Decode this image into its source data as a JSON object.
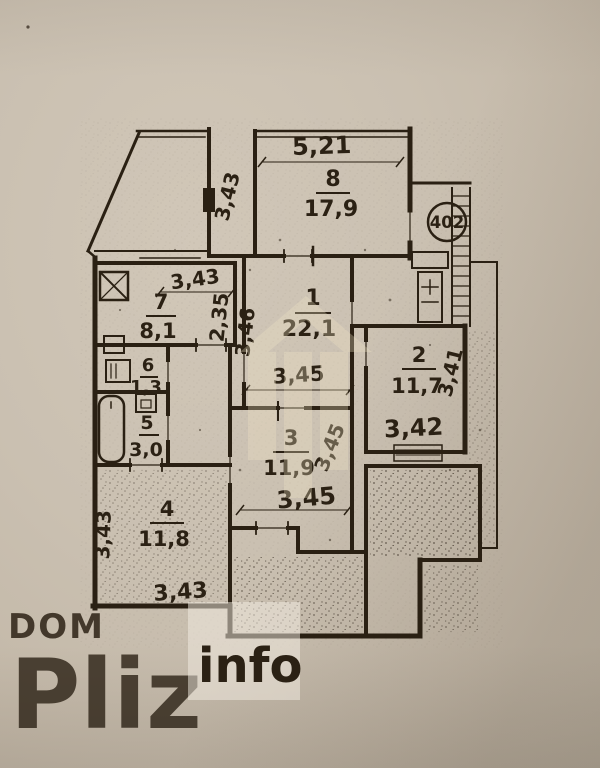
{
  "plan": {
    "apartment_number": "402",
    "rooms": [
      {
        "number": "1",
        "area": "22,1"
      },
      {
        "number": "2",
        "area": "11,7"
      },
      {
        "number": "3",
        "area": "11,9"
      },
      {
        "number": "4",
        "area": "11,8"
      },
      {
        "number": "5",
        "area": "3,0"
      },
      {
        "number": "6",
        "area": "1,3"
      },
      {
        "number": "7",
        "area": "8,1"
      },
      {
        "number": "8",
        "area": "17,9"
      }
    ],
    "dimensions": {
      "room8_width": "5,21",
      "room8_depth": "3,43",
      "room7_width": "3,43",
      "room7_depth": "2,35",
      "room1_depth": "3,46",
      "room1_width": "3,45",
      "room2_depth": "3,41",
      "room2_width": "3,42",
      "room3_depth": "3,45",
      "room3_width": "3,45",
      "room4_depth": "3,43",
      "room4_width": "3,43"
    }
  },
  "watermark": {
    "brand_top": "DOM",
    "brand_main": "Pliz",
    "brand_badge": "info"
  }
}
